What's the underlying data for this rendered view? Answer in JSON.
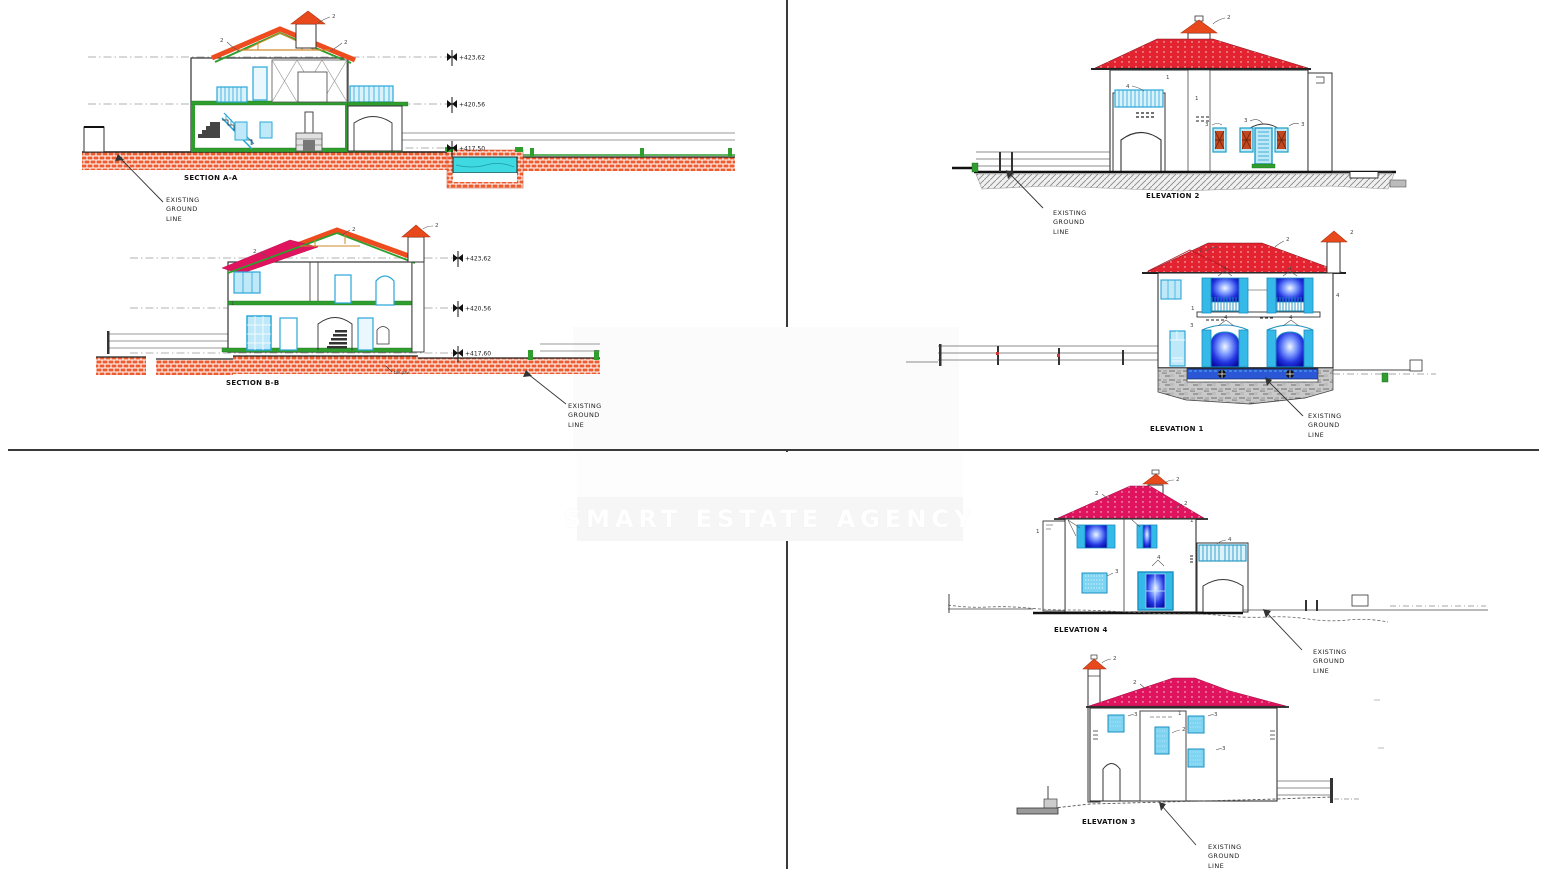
{
  "watermark": {
    "text": "SMART ESTATE AGENCY"
  },
  "ground_note": {
    "line1": "EXISTING",
    "line2": "GROUND",
    "line3": "LINE"
  },
  "callouts": {
    "n1": "1",
    "n2": "2",
    "n3": "3",
    "n4": "4"
  },
  "sections": {
    "aa": {
      "title": "SECTION A-A",
      "levels": [
        "+423,62",
        "+420,56",
        "+417,50"
      ]
    },
    "bb": {
      "title": "SECTION B-B",
      "levels": [
        "+423,62",
        "+420,56",
        "+417,60"
      ],
      "note": "tile pav."
    }
  },
  "elevations": {
    "e1": {
      "title": "ELEVATION 1"
    },
    "e2": {
      "title": "ELEVATION 2"
    },
    "e3": {
      "title": "ELEVATION 3"
    },
    "e4": {
      "title": "ELEVATION 4"
    }
  },
  "colors": {
    "roof_red": "#e32330",
    "roof_magenta": "#e0135f",
    "section_roof_orange": "#ee4b1e",
    "chimney_cap_orange": "#e8491c",
    "structure_green": "#2f9e2f",
    "joinery_cyan": "#35b9e9",
    "glass_glow_blue": "#1b2bd0",
    "brick_hatch_orange": "#ee5b2f",
    "pool_water_cyan": "#3fd9e2"
  }
}
